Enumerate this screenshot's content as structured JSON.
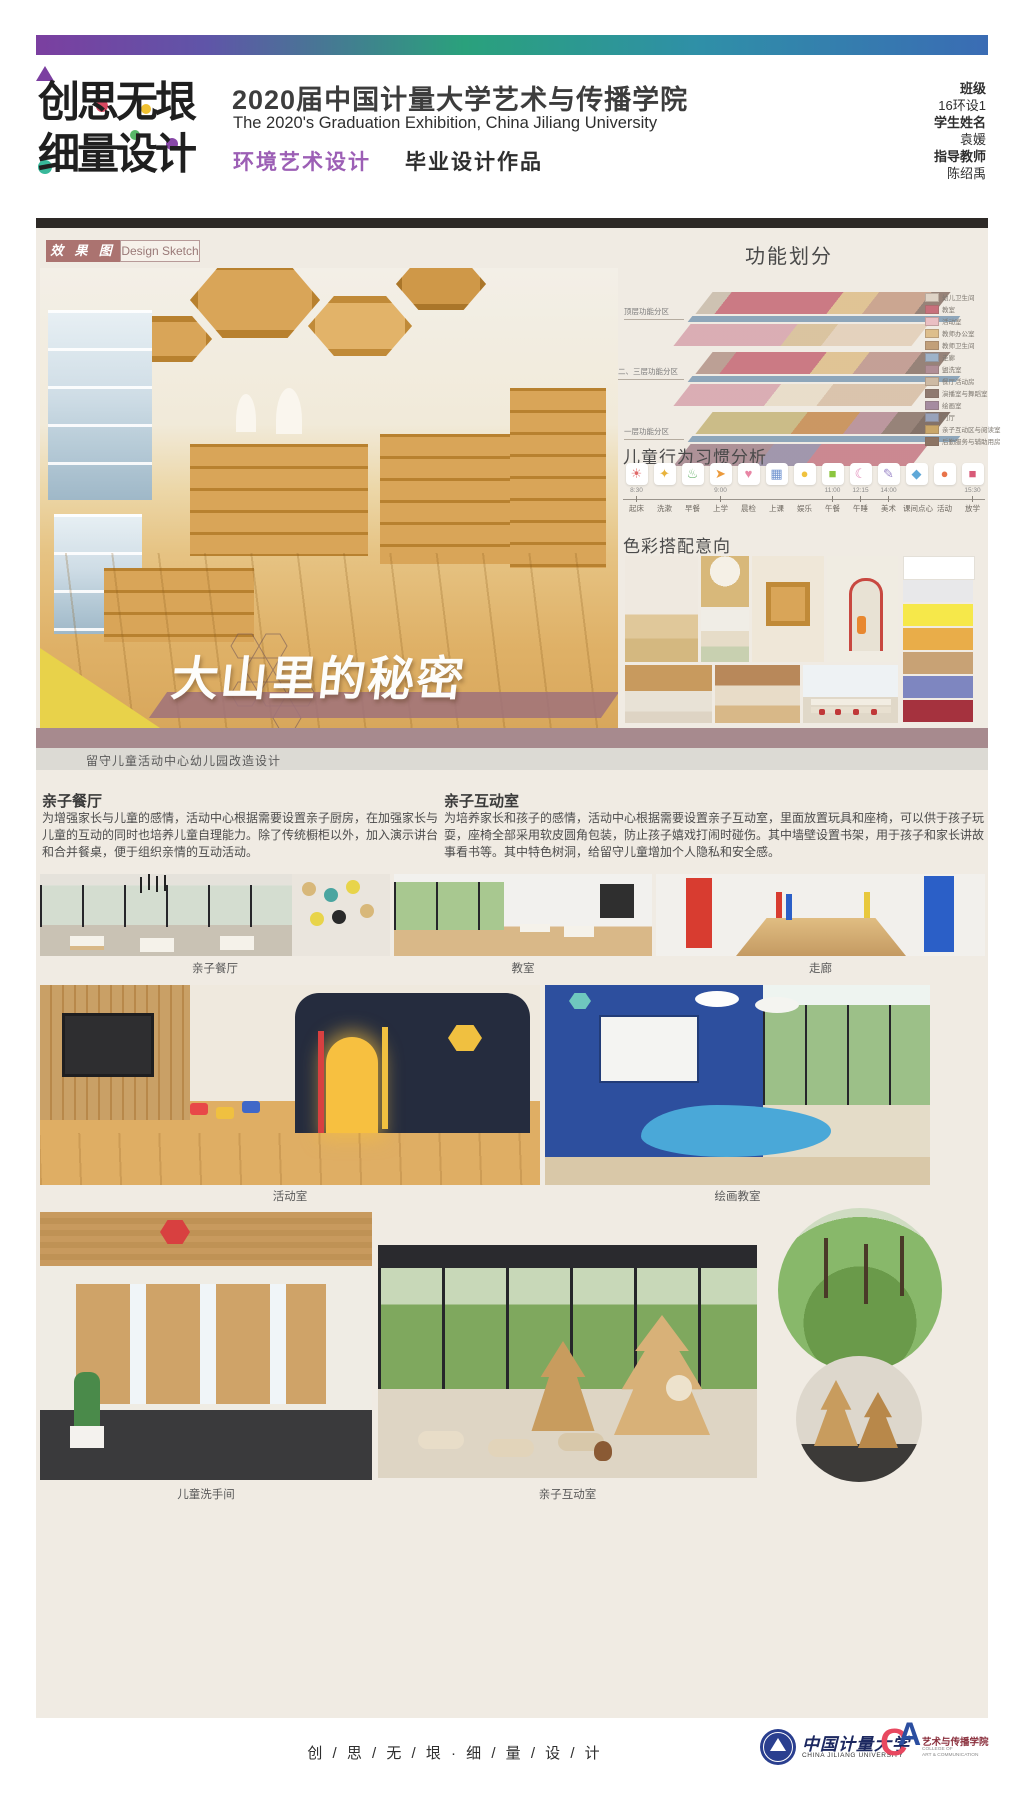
{
  "header": {
    "logo_line1": "创思无垠",
    "logo_line2": "细量设计",
    "title_cn": "2020届中国计量大学艺术与传播学院",
    "title_en": "The 2020's Graduation Exhibition, China Jiliang University",
    "major": "环境艺术设计",
    "work_type": "毕业设计作品",
    "info": [
      {
        "label": "班级",
        "value": "16环设1"
      },
      {
        "label": "学生姓名",
        "value": "袁媛"
      },
      {
        "label": "指导教师",
        "value": "陈绍禹"
      }
    ]
  },
  "section_tab": {
    "cn": "效 果 图",
    "en": "Design Sketch"
  },
  "hero": {
    "title": "大山里的秘密",
    "caption": "留守儿童活动中心幼儿园改造设计"
  },
  "function_zoning": {
    "title": "功能划分",
    "floors": [
      "顶层功能分区",
      "二、三层功能分区",
      "一层功能分区"
    ],
    "legend": [
      {
        "label": "幼儿卫生间",
        "color": "#ded3c6"
      },
      {
        "label": "教室",
        "color": "#c8707c"
      },
      {
        "label": "活动室",
        "color": "#eabfc3"
      },
      {
        "label": "教师办公室",
        "color": "#ddbe8c"
      },
      {
        "label": "教师卫生间",
        "color": "#c2a07a"
      },
      {
        "label": "走廊",
        "color": "#9eb3c9"
      },
      {
        "label": "盥洗室",
        "color": "#b08e96"
      },
      {
        "label": "餐厅活动房",
        "color": "#cdbaa4"
      },
      {
        "label": "演播室与舞蹈室",
        "color": "#8f7a70"
      },
      {
        "label": "绘画室",
        "color": "#a58ca0"
      },
      {
        "label": "门厅",
        "color": "#98a2ba"
      },
      {
        "label": "亲子互动区与阅读室",
        "color": "#c9a668"
      },
      {
        "label": "后勤服务与辅助用房",
        "color": "#8c7464"
      }
    ]
  },
  "behavior": {
    "title": "儿童行为习惯分析",
    "items": [
      {
        "icon": "sunrise-icon",
        "glyph": "☀",
        "color": "#e06a6a",
        "label": "起床",
        "time": "8:30"
      },
      {
        "icon": "toothpaste-icon",
        "glyph": "✦",
        "color": "#e8b33c",
        "label": "洗漱",
        "time": ""
      },
      {
        "icon": "breakfast-icon",
        "glyph": "♨",
        "color": "#6ab56e",
        "label": "早餐",
        "time": ""
      },
      {
        "icon": "footprints-icon",
        "glyph": "➤",
        "color": "#eb9a3c",
        "label": "上学",
        "time": "9:00"
      },
      {
        "icon": "health-check-icon",
        "glyph": "♥",
        "color": "#e886a5",
        "label": "晨检",
        "time": ""
      },
      {
        "icon": "blocks-icon",
        "glyph": "▦",
        "color": "#6f93cf",
        "label": "上课",
        "time": ""
      },
      {
        "icon": "duck-icon",
        "glyph": "●",
        "color": "#f0c23e",
        "label": "娱乐",
        "time": ""
      },
      {
        "icon": "lunch-icon",
        "glyph": "■",
        "color": "#8cc63f",
        "label": "午餐",
        "time": "11:00"
      },
      {
        "icon": "nap-icon",
        "glyph": "☾",
        "color": "#e082b4",
        "label": "午睡",
        "time": "12:15"
      },
      {
        "icon": "art-palette-icon",
        "glyph": "✎",
        "color": "#9a86c8",
        "label": "美术",
        "time": "14:00"
      },
      {
        "icon": "snack-icon",
        "glyph": "◆",
        "color": "#5fa8d8",
        "label": "课间点心",
        "time": ""
      },
      {
        "icon": "ball-icon",
        "glyph": "●",
        "color": "#e8734a",
        "label": "活动",
        "time": ""
      },
      {
        "icon": "school-bus-icon",
        "glyph": "■",
        "color": "#d85a78",
        "label": "放学",
        "time": "15:30"
      }
    ]
  },
  "color_scheme": {
    "title": "色彩搭配意向",
    "palette": [
      "#ffffff",
      "#e8e8ea",
      "#f6e84a",
      "#e9ad49",
      "#c8a275",
      "#7e86c0",
      "#a5323e"
    ]
  },
  "paragraphs": [
    {
      "title": "亲子餐厅",
      "text": "为增强家长与儿童的感情，活动中心根据需要设置亲子厨房，在加强家长与儿童的互动的同时也培养儿童自理能力。除了传统橱柜以外，加入演示讲台和合并餐桌，便于组织亲情的互动活动。"
    },
    {
      "title": "亲子互动室",
      "text": "为培养家长和孩子的感情，活动中心根据需要设置亲子互动室，里面放置玩具和座椅，可以供于孩子玩耍，座椅全部采用软皮圆角包装，防止孩子嬉戏打闹时碰伤。其中墙壁设置书架，用于孩子和家长讲故事看书等。其中特色树洞，给留守儿童增加个人隐私和安全感。"
    }
  ],
  "photos": [
    {
      "caption": "亲子餐厅"
    },
    {
      "caption": "教室"
    },
    {
      "caption": "走廊"
    },
    {
      "caption": "活动室"
    },
    {
      "caption": "绘画教室"
    },
    {
      "caption": "儿童洗手间"
    },
    {
      "caption": "亲子互动室"
    }
  ],
  "footer": {
    "slogan": "创 / 思 / 无 / 垠 · 细 / 量 / 设 / 计",
    "university_cn": "中国计量大学",
    "university_en": "CHINA JILIANG UNIVERSITY",
    "college_cn": "艺术与传播学院",
    "college_en1": "COLLEGE OF",
    "college_en2": "ART & COMMUNICATION"
  },
  "colors": {
    "accent_mauve": "#ab7370",
    "band_mauve": "#a78a8e",
    "content_beige": "#f0ebe3",
    "gradient_left": "#7b3fa0",
    "gradient_mid": "#2aa17c",
    "gradient_right": "#3a6cb4"
  }
}
